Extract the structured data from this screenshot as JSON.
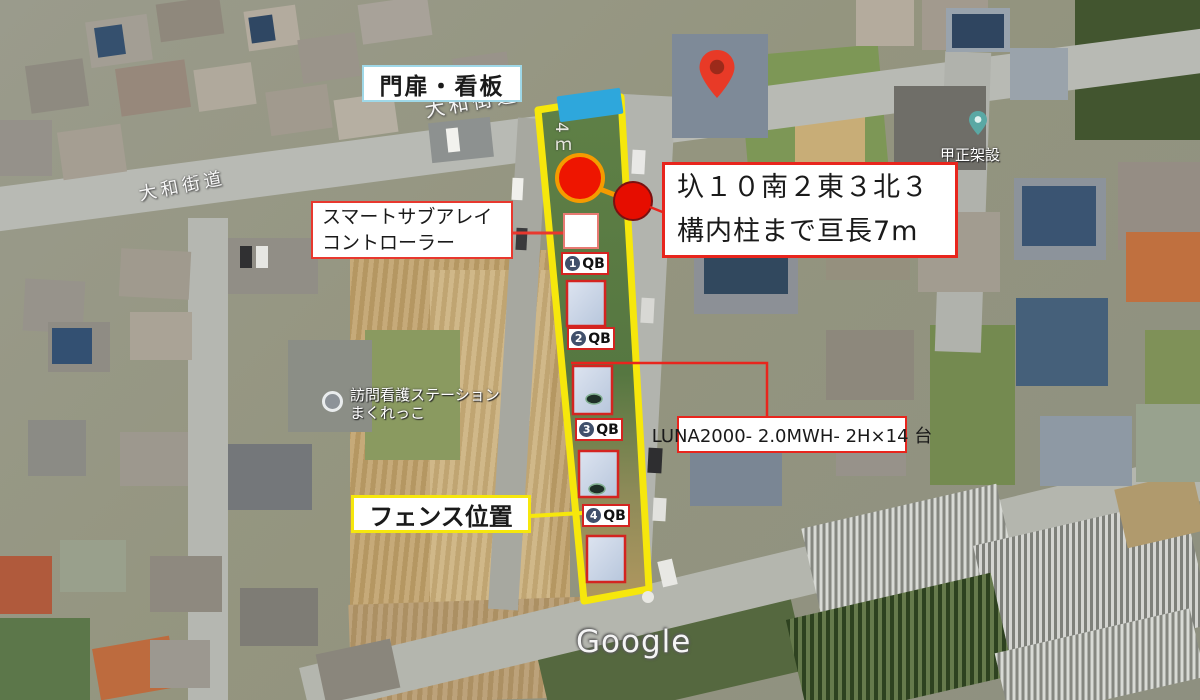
{
  "colors": {
    "boundary_yellow": "#f6e70c",
    "annotation_red": "#e8251d",
    "gate_blue": "#2ea7dc",
    "label_border_blue": "#9fd8e8",
    "marker_red_fill": "#ee1500",
    "marker_orange_ring": "#f59b00",
    "battery_box_fill": "#cfd9e8"
  },
  "labels": {
    "gate_sign": "門扉・看板",
    "controller_line1": "スマートサブアレイ",
    "controller_line2": "コントローラー",
    "pole_note_line1": "圦１０南２東３北３",
    "pole_note_line2": "構内柱まで亘長7m",
    "battery_spec": "LUNA2000- 2.0MWH- 2H×14 台",
    "fence_position": "フェンス位置",
    "gate_width": "4ｍ"
  },
  "qb_units": [
    {
      "number": "1",
      "label": "QB"
    },
    {
      "number": "2",
      "label": "QB"
    },
    {
      "number": "3",
      "label": "QB"
    },
    {
      "number": "4",
      "label": "QB"
    }
  ],
  "map": {
    "road_label_left": "大和街道",
    "road_label_top": "大和街道",
    "place_nursing_line1": "訪問看護ステーション",
    "place_nursing_line2": "まくれっこ",
    "place_right": "甲正架設",
    "watermark": "Google"
  }
}
